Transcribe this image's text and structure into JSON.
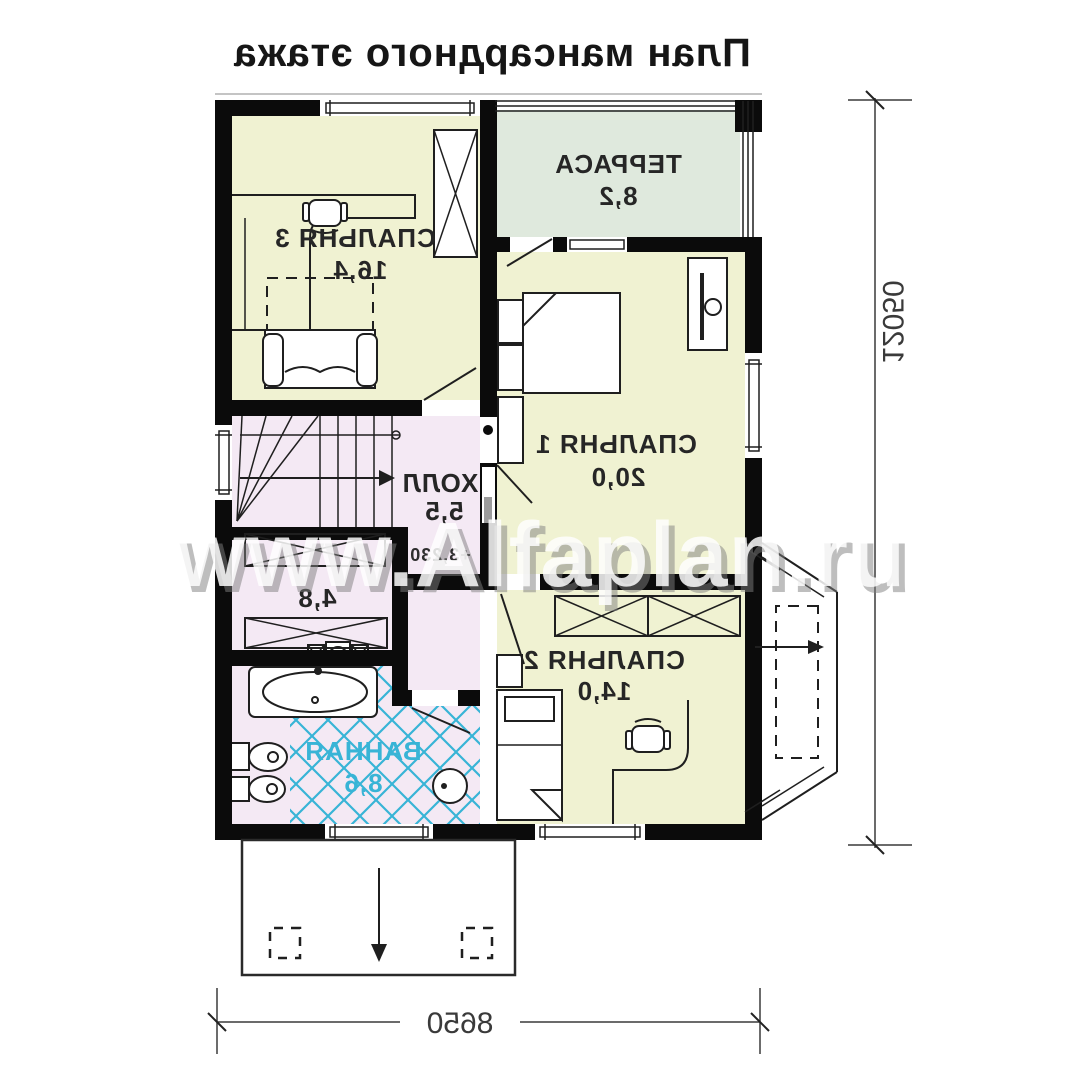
{
  "title": "План мансардного этажа",
  "watermark": "www.Alfaplan.ru",
  "rooms": {
    "bedroom3": {
      "label": "СПАЛЬНЯ 3",
      "area": "16,4"
    },
    "terrace": {
      "label": "ТЕРРАСА",
      "area": "8,2"
    },
    "bedroom1": {
      "label": "СПАЛЬНЯ 1",
      "area": "20,0"
    },
    "hall": {
      "label": "ХОЛЛ",
      "area": "5,5",
      "level_mark": "+3,230"
    },
    "dressing": {
      "label": "",
      "area": "4,8"
    },
    "bathroom": {
      "label": "ВАННАЯ",
      "area": "8,6"
    },
    "bedroom2": {
      "label": "СПАЛЬНЯ 2",
      "area": "14,0"
    }
  },
  "dimensions": {
    "overall_depth": "12050",
    "overall_width": "8650"
  },
  "colors": {
    "room-yellow": "#f0f2d2",
    "terrace-green": "#dfe9dd",
    "hall-pink": "#f4e9f4",
    "hatch-cyan": "#38b4d6",
    "wall-black": "#0b0b0b",
    "label-dark": "#262626",
    "dim-gray": "#3a3a3a"
  }
}
